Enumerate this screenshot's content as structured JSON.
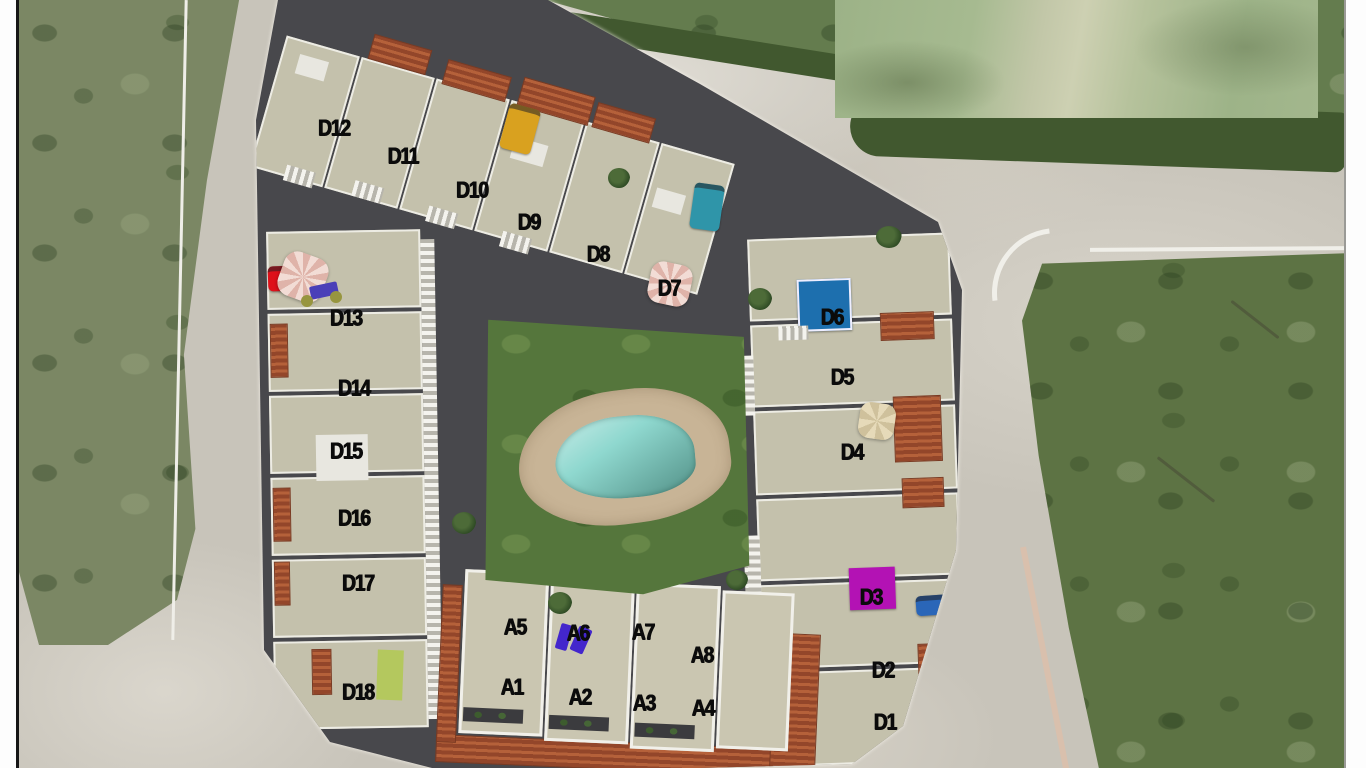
{
  "site": {
    "name": "Residential complex aerial site plan",
    "blocks": [
      "A",
      "D"
    ]
  },
  "units": {
    "d_block": [
      {
        "id": "D1",
        "x": 885,
        "y": 722
      },
      {
        "id": "D2",
        "x": 883,
        "y": 670
      },
      {
        "id": "D3",
        "x": 871,
        "y": 597
      },
      {
        "id": "D4",
        "x": 852,
        "y": 452
      },
      {
        "id": "D5",
        "x": 842,
        "y": 377
      },
      {
        "id": "D6",
        "x": 832,
        "y": 317
      },
      {
        "id": "D7",
        "x": 669,
        "y": 288
      },
      {
        "id": "D8",
        "x": 598,
        "y": 254
      },
      {
        "id": "D9",
        "x": 529,
        "y": 222
      },
      {
        "id": "D10",
        "x": 472,
        "y": 190
      },
      {
        "id": "D11",
        "x": 403,
        "y": 156
      },
      {
        "id": "D12",
        "x": 334,
        "y": 128
      },
      {
        "id": "D13",
        "x": 346,
        "y": 318
      },
      {
        "id": "D14",
        "x": 354,
        "y": 388
      },
      {
        "id": "D15",
        "x": 346,
        "y": 451
      },
      {
        "id": "D16",
        "x": 354,
        "y": 518
      },
      {
        "id": "D17",
        "x": 358,
        "y": 583
      },
      {
        "id": "D18",
        "x": 358,
        "y": 692
      }
    ],
    "a_block": [
      {
        "id": "A1",
        "x": 512,
        "y": 687
      },
      {
        "id": "A2",
        "x": 580,
        "y": 697
      },
      {
        "id": "A3",
        "x": 644,
        "y": 703
      },
      {
        "id": "A4",
        "x": 703,
        "y": 708
      },
      {
        "id": "A5",
        "x": 515,
        "y": 627
      },
      {
        "id": "A6",
        "x": 578,
        "y": 633
      },
      {
        "id": "A7",
        "x": 643,
        "y": 632
      },
      {
        "id": "A8",
        "x": 702,
        "y": 655
      }
    ]
  },
  "features": {
    "label_color": "#0b0b0b",
    "communal_pool_color": "#8fd8cf",
    "lawn_color": "#55763c",
    "rooftop_pool_d6_color": "#1d6fae",
    "panel_d3_color": "#b312b4",
    "purple_loungers_a6_color": "#4326cc",
    "cars": [
      {
        "name": "yellow-car",
        "color": "#d9a11f"
      },
      {
        "name": "teal-car",
        "color": "#2f95a9"
      },
      {
        "name": "blue-car",
        "color": "#2a66b8"
      },
      {
        "name": "red-car",
        "color": "#de1019"
      }
    ],
    "umbrellas": [
      {
        "name": "pink-umbrella-d13",
        "color": "#eed3cc"
      },
      {
        "name": "pink-umbrella-d7",
        "color": "#eed3cc"
      },
      {
        "name": "beige-umbrella-d4",
        "color": "#e4d8b8"
      }
    ]
  }
}
